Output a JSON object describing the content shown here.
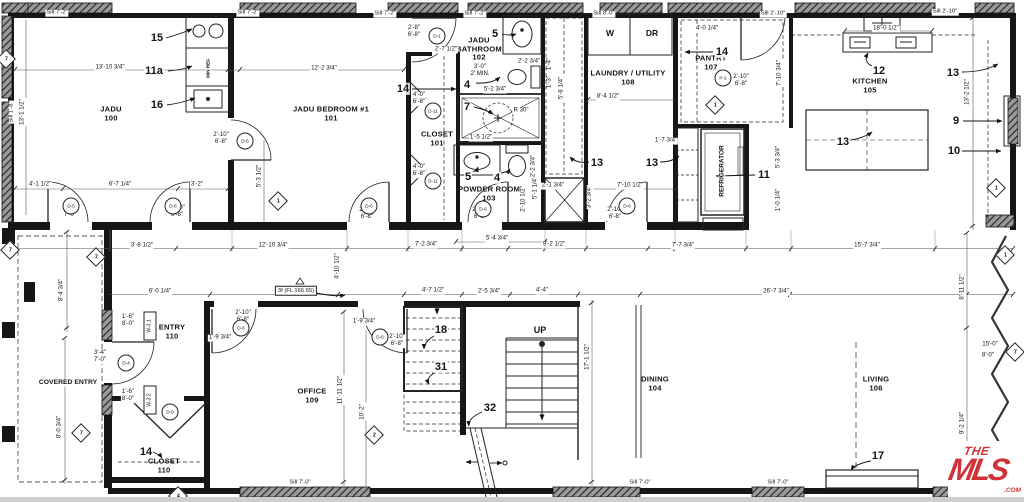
{
  "logo": {
    "the": "THE",
    "name": "MLS",
    "tm": "™",
    "com": ".COM",
    "color": "#ce3338"
  },
  "labels": {
    "rooms": [
      {
        "t": "JADU\n100",
        "x": 111,
        "y": 114
      },
      {
        "t": "JADU BEDROOM #1\n101",
        "x": 331,
        "y": 114
      },
      {
        "t": "JADU\nBATHROOM\n102",
        "x": 479,
        "y": 49
      },
      {
        "t": "CLOSET\n101",
        "x": 437,
        "y": 139
      },
      {
        "t": "POWDER ROOM\n103",
        "x": 489,
        "y": 194
      },
      {
        "t": "LAUNDRY / UTILITY\n108",
        "x": 628,
        "y": 78
      },
      {
        "t": "PANTRY\n107",
        "x": 711,
        "y": 63
      },
      {
        "t": "KITCHEN\n105",
        "x": 870,
        "y": 86
      },
      {
        "t": "ENTRY\n110",
        "x": 172,
        "y": 332
      },
      {
        "t": "OFFICE\n109",
        "x": 312,
        "y": 396
      },
      {
        "t": "DINING\n104",
        "x": 655,
        "y": 384
      },
      {
        "t": "LIVING\n106",
        "x": 876,
        "y": 384
      },
      {
        "t": "CLOSET\n110",
        "x": 164,
        "y": 466
      }
    ],
    "annos": [
      {
        "t": "W",
        "x": 610,
        "y": 34,
        "s": 8.5
      },
      {
        "t": "DR",
        "x": 652,
        "y": 34,
        "s": 8.5
      },
      {
        "t": "UP",
        "x": 540,
        "y": 330,
        "s": 9
      },
      {
        "t": "REFRIGERATOR",
        "x": 722,
        "y": 171,
        "v": 1,
        "s": 6.5
      },
      {
        "t": "MIN REF.",
        "x": 208,
        "y": 68,
        "v": 1,
        "s": 4.6
      },
      {
        "t": "COVERED ENTRY",
        "x": 68,
        "y": 383,
        "s": 6.8
      }
    ],
    "callouts": [
      {
        "t": "15",
        "x": 157,
        "y": 38
      },
      {
        "t": "11a",
        "x": 154,
        "y": 71
      },
      {
        "t": "16",
        "x": 157,
        "y": 105
      },
      {
        "t": "14",
        "x": 403,
        "y": 89
      },
      {
        "t": "5",
        "x": 495,
        "y": 34
      },
      {
        "t": "4",
        "x": 467,
        "y": 85
      },
      {
        "t": "7",
        "x": 467,
        "y": 107
      },
      {
        "t": "13",
        "x": 597,
        "y": 163
      },
      {
        "t": "13",
        "x": 652,
        "y": 163
      },
      {
        "t": "11",
        "x": 764,
        "y": 175
      },
      {
        "t": "14",
        "x": 722,
        "y": 52
      },
      {
        "t": "12",
        "x": 879,
        "y": 71
      },
      {
        "t": "13",
        "x": 953,
        "y": 73
      },
      {
        "t": "9",
        "x": 956,
        "y": 121
      },
      {
        "t": "10",
        "x": 954,
        "y": 151
      },
      {
        "t": "13",
        "x": 843,
        "y": 142
      },
      {
        "t": "18",
        "x": 441,
        "y": 330
      },
      {
        "t": "31",
        "x": 441,
        "y": 367
      },
      {
        "t": "32",
        "x": 490,
        "y": 408
      },
      {
        "t": "14",
        "x": 146,
        "y": 452
      },
      {
        "t": "17",
        "x": 878,
        "y": 456
      },
      {
        "t": "5",
        "x": 468,
        "y": 177
      },
      {
        "t": "4",
        "x": 497,
        "y": 178
      }
    ],
    "dims": [
      {
        "t": "13'-10 3/4\"",
        "x": 110,
        "y": 68
      },
      {
        "t": "12'-2 3/4\"",
        "x": 324,
        "y": 69
      },
      {
        "t": "8'-4 1/2\"",
        "x": 608,
        "y": 97
      },
      {
        "t": "18'-0 1/2\"",
        "x": 886,
        "y": 29
      },
      {
        "t": "2'-8\"\n6'-8\"",
        "x": 414,
        "y": 32
      },
      {
        "t": "2'-7 1/2\"",
        "x": 446,
        "y": 50
      },
      {
        "t": "3'-0\"\n2' MIN.",
        "x": 480,
        "y": 71
      },
      {
        "t": "2'-2 3/4\"",
        "x": 529,
        "y": 62
      },
      {
        "t": "5'-2 3/4\"",
        "x": 495,
        "y": 90
      },
      {
        "t": "R 30\"",
        "x": 521,
        "y": 111
      },
      {
        "t": "1'-5 1/2\"",
        "x": 481,
        "y": 138
      },
      {
        "t": "2'-1 3/4\"",
        "x": 553,
        "y": 186
      },
      {
        "t": "7'-10 1/2\"",
        "x": 630,
        "y": 186
      },
      {
        "t": "1'-7 3/4\"",
        "x": 666,
        "y": 141
      },
      {
        "t": "3'-2 3/4\"",
        "x": 590,
        "y": 197,
        "v": 1
      },
      {
        "t": "4'-1 1/2\"",
        "x": 40,
        "y": 185
      },
      {
        "t": "6'-7 1/4\"",
        "x": 120,
        "y": 185
      },
      {
        "t": "3'-2\"",
        "x": 197,
        "y": 185
      },
      {
        "t": "5'-3 1/2\"",
        "x": 260,
        "y": 176,
        "v": 1
      },
      {
        "t": "2'-10\"\n6'-8\"",
        "x": 221,
        "y": 139
      },
      {
        "t": "3'-8 1/2\"",
        "x": 142,
        "y": 246
      },
      {
        "t": "12'-10 3/4\"",
        "x": 273,
        "y": 246
      },
      {
        "t": "7'-2 3/4\"",
        "x": 426,
        "y": 245
      },
      {
        "t": "5'-4 3/4\"",
        "x": 497,
        "y": 239
      },
      {
        "t": "9'-2 1/2\"",
        "x": 554,
        "y": 245
      },
      {
        "t": "7'-7 3/4\"",
        "x": 683,
        "y": 246
      },
      {
        "t": "15'-7 3/4\"",
        "x": 867,
        "y": 246
      },
      {
        "t": "26'-7 3/4\"",
        "x": 776,
        "y": 292
      },
      {
        "t": "6'-0 1/4\"",
        "x": 160,
        "y": 292
      },
      {
        "t": "4'-7 1/2\"",
        "x": 433,
        "y": 291
      },
      {
        "t": "2'-5 3/4\"",
        "x": 489,
        "y": 292
      },
      {
        "t": "4'-4\"",
        "x": 542,
        "y": 291
      },
      {
        "t": "17'-1 1/2\"",
        "x": 588,
        "y": 357,
        "v": 1
      },
      {
        "t": "8'-11 1/2\"",
        "x": 963,
        "y": 287,
        "v": 1
      },
      {
        "t": "9'-2 1/4\"",
        "x": 963,
        "y": 423,
        "v": 1
      },
      {
        "t": "13'-2 1/2\"",
        "x": 968,
        "y": 92,
        "v": 1
      },
      {
        "t": "7'-10 3/4\"",
        "x": 780,
        "y": 73,
        "v": 1
      },
      {
        "t": "5'-3 3/4\"",
        "x": 779,
        "y": 157,
        "v": 1
      },
      {
        "t": "1'-0 1/4\"",
        "x": 779,
        "y": 200,
        "v": 1
      },
      {
        "t": "5'-8 1/4\"",
        "x": 562,
        "y": 88,
        "v": 1
      },
      {
        "t": "1'-4\"",
        "x": 550,
        "y": 64,
        "v": 1
      },
      {
        "t": "1'-3\"",
        "x": 550,
        "y": 82,
        "v": 1
      },
      {
        "t": "4'-10 1/2\"",
        "x": 338,
        "y": 266,
        "v": 1
      },
      {
        "t": "11'-11 1/2\"",
        "x": 341,
        "y": 390,
        "v": 1
      },
      {
        "t": "10'-2\"",
        "x": 363,
        "y": 412,
        "v": 1
      },
      {
        "t": "8'-4 3/4\"",
        "x": 62,
        "y": 290,
        "v": 1
      },
      {
        "t": "8'-0 3/4\"",
        "x": 60,
        "y": 427,
        "v": 1
      },
      {
        "t": "13'-1 1/2\"",
        "x": 23,
        "y": 112,
        "v": 1
      },
      {
        "t": "1'-9 3/4\"",
        "x": 220,
        "y": 338
      },
      {
        "t": "1'-9 3/4\"",
        "x": 364,
        "y": 322
      },
      {
        "t": "2'-10\"\n6'-8\"",
        "x": 243,
        "y": 317
      },
      {
        "t": "2'-10\"\n6'-8\"",
        "x": 397,
        "y": 341
      },
      {
        "t": "2'-10\"\n6'-8\"",
        "x": 741,
        "y": 81
      },
      {
        "t": "4'-0\"\n6'-8\"",
        "x": 419,
        "y": 99
      },
      {
        "t": "4'-0\"\n6'-8\"",
        "x": 419,
        "y": 171
      },
      {
        "t": "1'-6\"\n8'-0\"",
        "x": 128,
        "y": 321
      },
      {
        "t": "1'-6\"\n8'-0\"",
        "x": 128,
        "y": 396
      },
      {
        "t": "3'-4\"\n7'-0\"",
        "x": 100,
        "y": 357
      },
      {
        "t": "3'-0\"\n7'-0\"",
        "x": 70,
        "y": 212
      },
      {
        "t": "2'-10\"\n6'-8\"",
        "x": 177,
        "y": 212
      },
      {
        "t": "2'-10\"\n6'-8\"",
        "x": 367,
        "y": 214
      },
      {
        "t": "2'-10\"\n6'-8\"",
        "x": 480,
        "y": 214
      },
      {
        "t": "2'-10\"\n6'-8\"",
        "x": 615,
        "y": 214
      },
      {
        "t": "4'-0 1/4\"",
        "x": 707,
        "y": 29
      },
      {
        "t": "15'-0\"",
        "x": 990,
        "y": 345
      },
      {
        "t": "8'-0\"",
        "x": 988,
        "y": 356
      },
      {
        "t": "5'-1 1/4\"",
        "x": 536,
        "y": 188,
        "v": 1
      },
      {
        "t": "2'-10 1/2\"",
        "x": 524,
        "y": 199,
        "v": 1
      },
      {
        "t": "2'-2 3/4\"",
        "x": 534,
        "y": 166,
        "v": 1
      }
    ],
    "sills": [
      {
        "t": "Sill 7'-2\"",
        "x": 57,
        "y": 13
      },
      {
        "t": "Sill 7'-2\"",
        "x": 248,
        "y": 13
      },
      {
        "t": "Sill 7'-2\"",
        "x": 385,
        "y": 14
      },
      {
        "t": "Sill 7'-2\"",
        "x": 475,
        "y": 14
      },
      {
        "t": "Sill 8'-0\"",
        "x": 604,
        "y": 14
      },
      {
        "t": "Sill 2'-10\"",
        "x": 773,
        "y": 14
      },
      {
        "t": "Sill 2'-10\"",
        "x": 945,
        "y": 12
      },
      {
        "t": "Sill 7'-0\"",
        "x": 300,
        "y": 483
      },
      {
        "t": "Sill 7'-0\"",
        "x": 640,
        "y": 483
      },
      {
        "t": "Sill 7'-0\"",
        "x": 778,
        "y": 483
      },
      {
        "t": "Sill 1'-8\"",
        "x": 12,
        "y": 112,
        "v": 1
      }
    ],
    "doortags": [
      {
        "t": "D-5",
        "x": 71,
        "y": 206
      },
      {
        "t": "D-6",
        "x": 173,
        "y": 206
      },
      {
        "t": "D-6",
        "x": 245,
        "y": 141
      },
      {
        "t": "D-6",
        "x": 369,
        "y": 206
      },
      {
        "t": "D-6",
        "x": 483,
        "y": 209
      },
      {
        "t": "D-6",
        "x": 627,
        "y": 206
      },
      {
        "t": "D-6",
        "x": 241,
        "y": 328
      },
      {
        "t": "D-6",
        "x": 380,
        "y": 337
      },
      {
        "t": "D-4",
        "x": 126,
        "y": 363
      },
      {
        "t": "D-9",
        "x": 170,
        "y": 412
      },
      {
        "t": "D-11",
        "x": 433,
        "y": 111
      },
      {
        "t": "D-11",
        "x": 433,
        "y": 181
      },
      {
        "t": "D-1",
        "x": 437,
        "y": 36
      },
      {
        "t": "P-2",
        "x": 723,
        "y": 78
      }
    ],
    "wintags": [
      {
        "t": "W-3.1",
        "x": 150,
        "y": 326,
        "v": 1
      },
      {
        "t": "W-3.2",
        "x": 150,
        "y": 400,
        "v": 1
      }
    ],
    "diamonds": [
      {
        "t": "7",
        "x": 6,
        "y": 59
      },
      {
        "t": "7",
        "x": 10,
        "y": 250
      },
      {
        "t": "7",
        "x": 96,
        "y": 257
      },
      {
        "t": "7",
        "x": 81,
        "y": 433
      },
      {
        "t": "1",
        "x": 278,
        "y": 201
      },
      {
        "t": "1",
        "x": 715,
        "y": 105
      },
      {
        "t": "1",
        "x": 996,
        "y": 188
      },
      {
        "t": "1",
        "x": 1005,
        "y": 255
      },
      {
        "t": "7",
        "x": 1015,
        "y": 352
      },
      {
        "t": "2",
        "x": 374,
        "y": 435
      },
      {
        "t": "4",
        "x": 178,
        "y": 496
      }
    ],
    "tags": [
      {
        "t": "3f (FL 166.65)",
        "x": 296,
        "y": 291
      }
    ]
  }
}
